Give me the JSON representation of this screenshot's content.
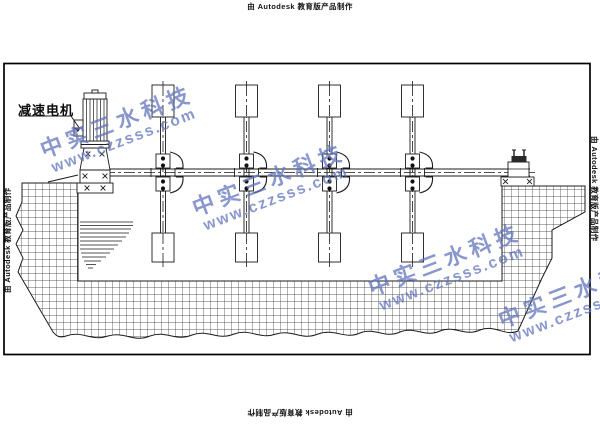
{
  "stamps": {
    "autodesk": "由 Autodesk 教育版产品制作"
  },
  "drawing": {
    "motor_label": "减速电机",
    "line_color": "#1b1b1b",
    "frame_color": "#000000",
    "mixer_count": 4
  },
  "watermark": {
    "brand": "中实三水科技",
    "url": "www.czzsss.com",
    "color": "#6274bc"
  }
}
